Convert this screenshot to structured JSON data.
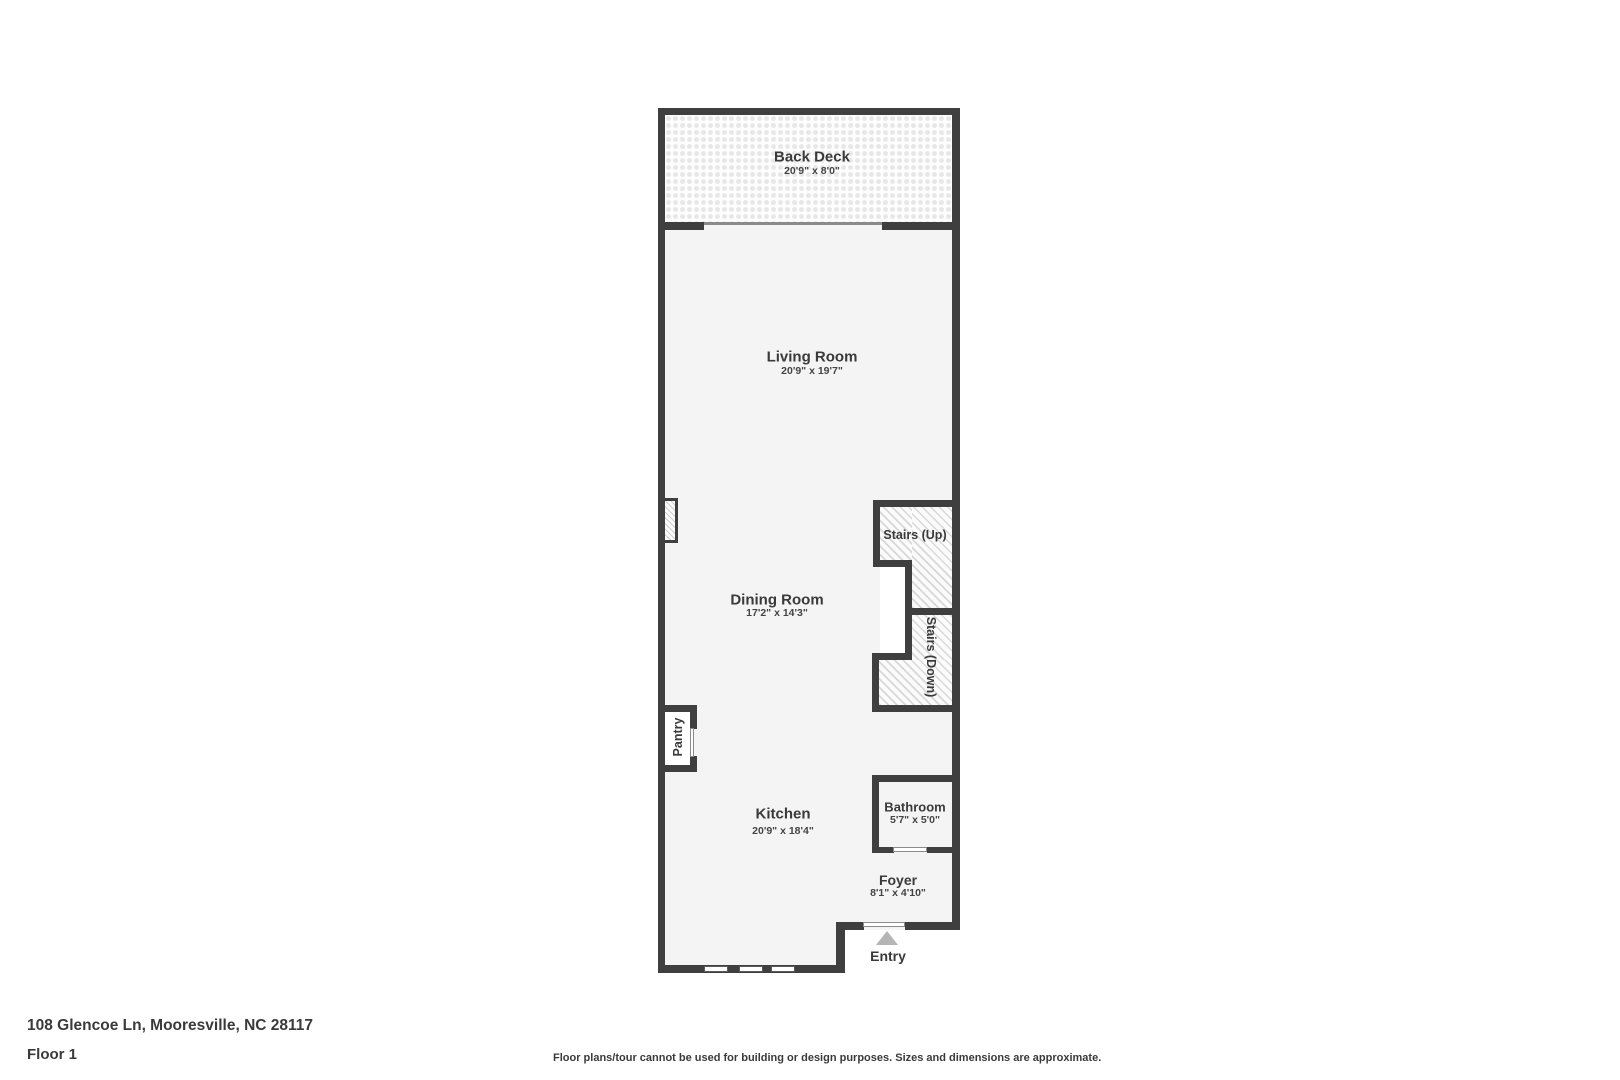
{
  "plan": {
    "rooms": [
      {
        "name": "Back Deck",
        "dims": "20'9\" x 8'0\""
      },
      {
        "name": "Living Room",
        "dims": "20'9\" x 19'7\""
      },
      {
        "name": "Dining Room",
        "dims": "17'2\" x 14'3\""
      },
      {
        "name": "Kitchen",
        "dims": "20'9\" x 18'4\""
      },
      {
        "name": "Bathroom",
        "dims": "5'7\" x 5'0\""
      },
      {
        "name": "Foyer",
        "dims": "8'1\" x 4'10\""
      },
      {
        "name": "Stairs (Up)"
      },
      {
        "name": "Stairs (Down)"
      },
      {
        "name": "Pantry"
      },
      {
        "name": "Entry"
      }
    ],
    "icons": [
      "entry-arrow"
    ]
  },
  "footer": {
    "address": "108 Glencoe Ln, Mooresville, NC 28117",
    "floor": "Floor 1",
    "disclaimer": "Floor plans/tour cannot be used for building or design purposes. Sizes and dimensions are approximate."
  },
  "colors": {
    "wall": "#3f3f3f",
    "room_fill": "#f4f4f4",
    "text": "#3a3a3a",
    "entry_arrow": "#b5b5b5"
  }
}
